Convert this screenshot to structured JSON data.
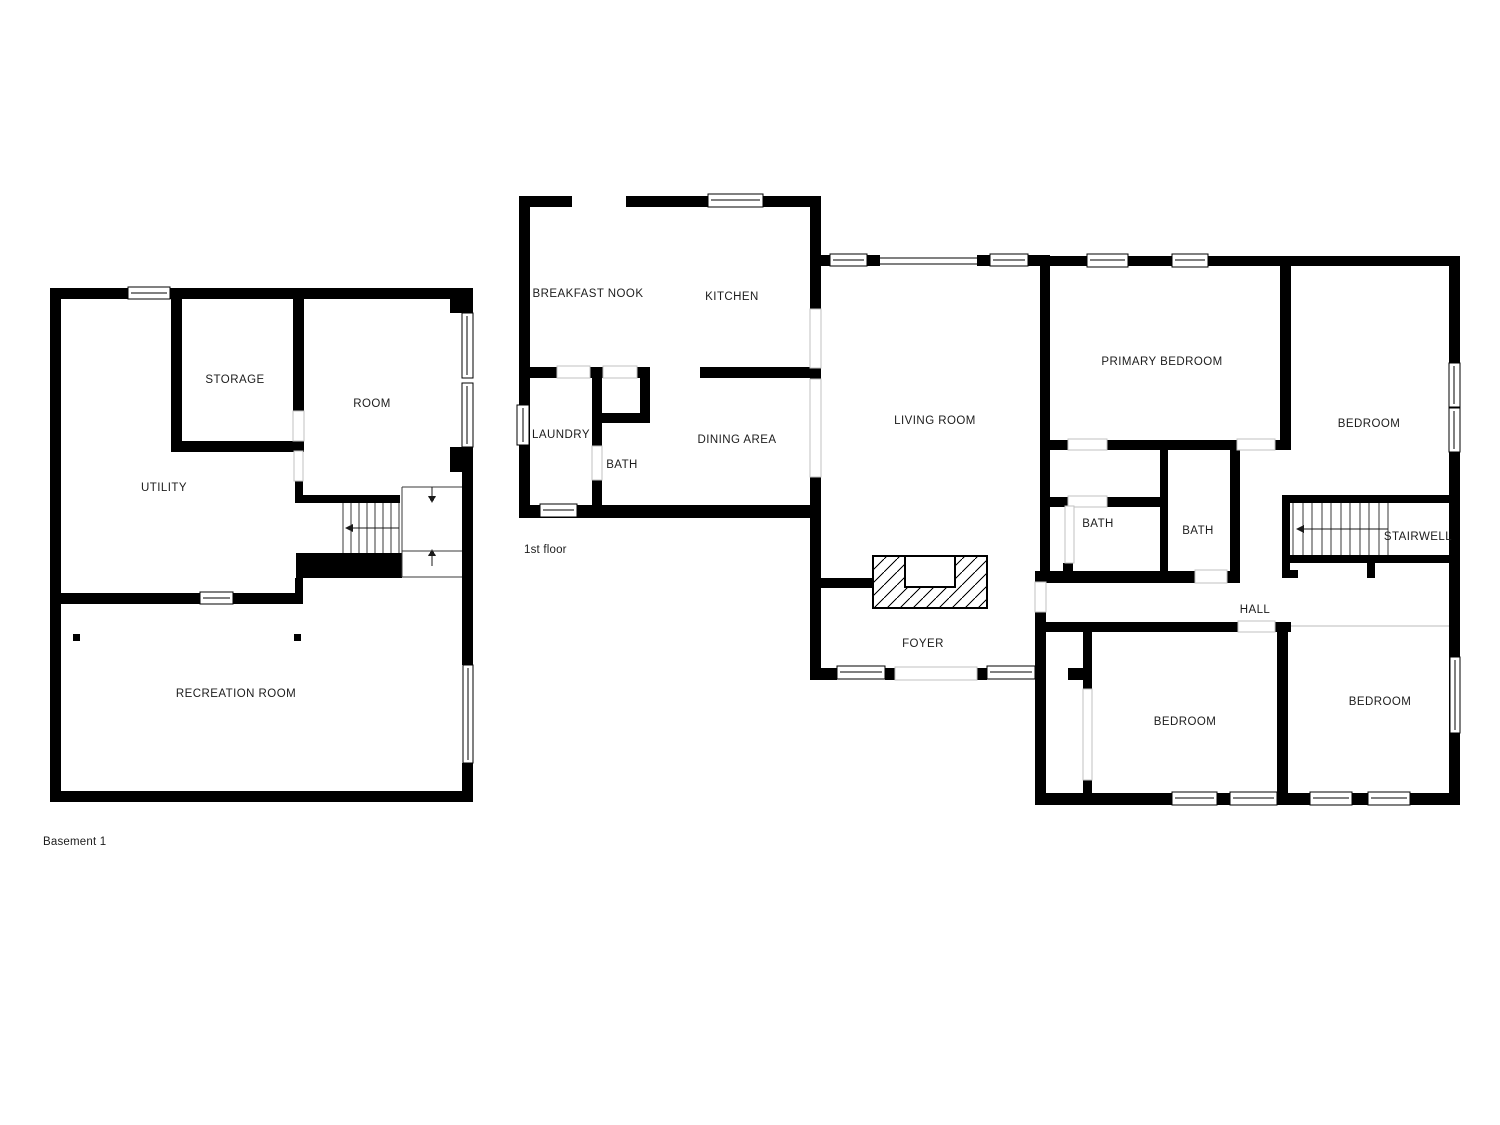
{
  "app": {
    "background": "#ffffff",
    "wall_color": "#000000",
    "label_color": "#1c1c1c"
  },
  "basement": {
    "title": "Basement 1",
    "rooms": {
      "storage": "STORAGE",
      "room": "ROOM",
      "utility": "UTILITY",
      "recreation": "RECREATION ROOM"
    }
  },
  "first_floor": {
    "title": "1st floor",
    "rooms": {
      "breakfast_nook": "BREAKFAST NOOK",
      "kitchen": "KITCHEN",
      "laundry": "LAUNDRY",
      "bath_small": "BATH",
      "dining": "DINING AREA",
      "living": "LIVING ROOM",
      "foyer": "FOYER",
      "primary_bedroom": "PRIMARY BEDROOM",
      "bedroom_top_right": "BEDROOM",
      "bath_left": "BATH",
      "bath_right": "BATH",
      "stairwell": "STAIRWELL",
      "hall": "HALL",
      "bedroom_bottom_left": "BEDROOM",
      "bedroom_bottom_right": "BEDROOM"
    }
  }
}
